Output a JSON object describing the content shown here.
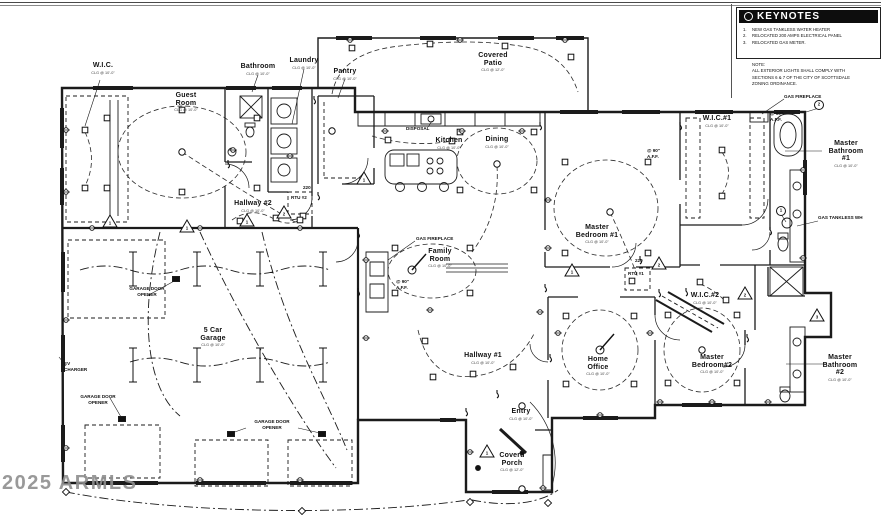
{
  "keynotes": {
    "title": "KEYNOTES",
    "nums": [
      "1.",
      "2.",
      "3."
    ],
    "items": [
      "NEW  GAS TANKLESS WATER HEATER",
      "RELOCATED 200 AMPS ELECTRICAL PANEL",
      "RELOCATED GAS METER."
    ],
    "note": "NOTE:\nALL EXTERIOR LIGHTS SHALL COMPLY WITH\nSECTIONS 6 & 7 OF THE CITY OF SCOTTSDALE\nZONING ORDINANCE."
  },
  "rooms": [
    {
      "name": "W.I.C.",
      "clg": "CLG @ 10'-0\""
    },
    {
      "name": "Guest\nRoom",
      "clg": "CLG @ 10'-0\""
    },
    {
      "name": "Bathroom",
      "clg": "CLG @ 10'-0\""
    },
    {
      "name": "Laundry",
      "clg": "CLG @ 10'-0\""
    },
    {
      "name": "Pantry",
      "clg": "CLG @ 10'-0\""
    },
    {
      "name": "Covered\nPatio",
      "clg": "CLG @ 12'-0\""
    },
    {
      "name": "Kitchen",
      "clg": "CLG @ 10'-0\""
    },
    {
      "name": "Dining",
      "clg": "CLG @ 10'-0\""
    },
    {
      "name": "Master\nBedroom #1",
      "clg": "CLG @ 10'-0\""
    },
    {
      "name": "W.I.C.#1",
      "clg": "CLG @ 10'-0\""
    },
    {
      "name": "Master\nBathroom #1",
      "clg": "CLG @ 10'-0\""
    },
    {
      "name": "Hallway #2",
      "clg": "CLG @ 10'-0\""
    },
    {
      "name": "5 Car\nGarage",
      "clg": "CLG @ 10'-0\""
    },
    {
      "name": "Family\nRoom",
      "clg": "CLG @ 10'-0\""
    },
    {
      "name": "Hallway #1",
      "clg": "CLG @ 10'-0\""
    },
    {
      "name": "Home\nOffice",
      "clg": "CLG @ 10'-0\""
    },
    {
      "name": "Entry",
      "clg": "CLG @ 10'-0\""
    },
    {
      "name": "Coverd\nPorch",
      "clg": "CLG @ 12'-0\""
    },
    {
      "name": "W.I.C.#2",
      "clg": "CLG @ 10'-0\""
    },
    {
      "name": "Master\nBedroom#2",
      "clg": "CLG @ 10'-0\""
    },
    {
      "name": "Master\nBathroom #2",
      "clg": "CLG @ 10'-0\""
    }
  ],
  "ann": [
    {
      "t": "GAS FIREPLACE"
    },
    {
      "t": "GAS FIREPLACE"
    },
    {
      "t": "GAS TANKLESS WH"
    },
    {
      "t": "DISPOSAL"
    },
    {
      "t": "RTU #1"
    },
    {
      "t": "RTU #2"
    },
    {
      "t": "220"
    },
    {
      "t": "220"
    },
    {
      "t": "EV\nCHARGER"
    },
    {
      "t": "GARAGE DOOR\nOPENER"
    },
    {
      "t": "GARAGE DOOR\nOPENER"
    },
    {
      "t": "GARAGE DOOR\nOPENER"
    },
    {
      "t": "@ 90\"\nA.F.F."
    },
    {
      "t": "@ 90\"\nA.F.F."
    },
    {
      "t": "@ 90\"\nA.F.F."
    }
  ],
  "markers": [
    {
      "v": "1"
    },
    {
      "v": "1"
    },
    {
      "v": "1"
    },
    {
      "v": "2"
    },
    {
      "v": "1"
    },
    {
      "v": "1"
    },
    {
      "v": "2"
    },
    {
      "v": "1"
    },
    {
      "v": "3"
    },
    {
      "v": "2"
    },
    {
      "v": "1"
    },
    {
      "v": "2"
    }
  ],
  "watermark": {
    "text": "2025 ARMLS"
  }
}
